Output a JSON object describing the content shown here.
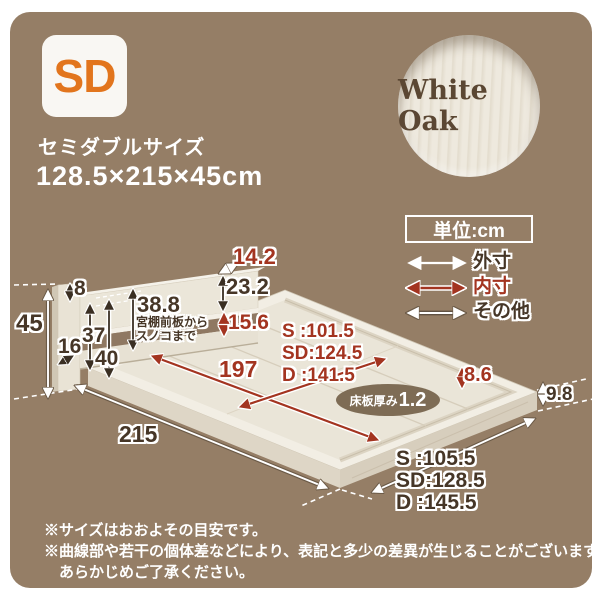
{
  "page": {
    "panel_bg": "#957e66",
    "accent_red": "#a33420",
    "text_dark": "#463627"
  },
  "badge": {
    "label": "SD"
  },
  "header": {
    "size_name": "セミダブルサイズ",
    "dimensions": "128.5×215×45cm"
  },
  "material": {
    "name": "White Oak"
  },
  "unit_box": {
    "label": "単位:cm"
  },
  "legend": {
    "outer": {
      "label": "外寸"
    },
    "inner": {
      "label": "内寸"
    },
    "other": {
      "label": "その他"
    }
  },
  "diagram": {
    "d8": "8",
    "d45": "45",
    "d16": "16",
    "d37": "37",
    "d40": "40",
    "d14_2": "14.2",
    "d23_2": "23.2",
    "d38_8": "38.8",
    "d38_8_note1": "宮棚前板から",
    "d38_8_note2": "スノコまで",
    "d15_6": "15.6",
    "d197": "197",
    "inner_width_s": "S :101.5",
    "inner_width_sd": "SD:124.5",
    "inner_width_d": "D :141.5",
    "board_label": "床板厚み",
    "board_value": "1.2",
    "d8_6": "8.6",
    "d9_8": "9.8",
    "d215": "215",
    "outer_width_s": "S :105.5",
    "outer_width_sd": "SD:128.5",
    "outer_width_d": "D :145.5"
  },
  "notes": {
    "line1": "※サイズはおおよその目安です。",
    "line2": "※曲線部や若干の個体差などにより、表記と多少の差異が生じることがございます。",
    "line3": "あらかじめご了承ください。"
  }
}
